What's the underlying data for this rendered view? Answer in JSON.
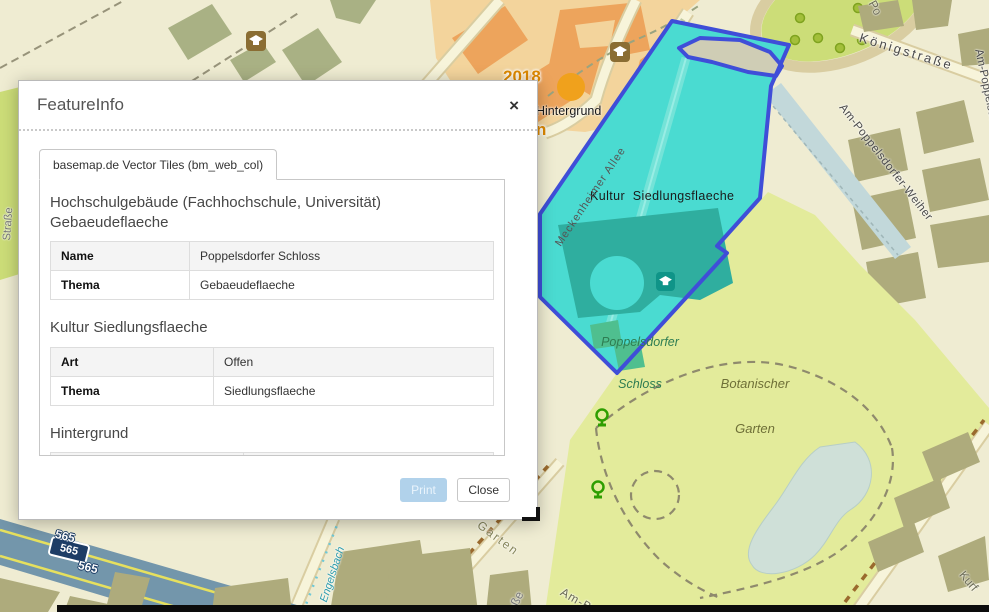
{
  "dialog": {
    "title": "FeatureInfo",
    "close_icon": "×",
    "tab_label": "basemap.de Vector Tiles (bm_web_col)",
    "sections": [
      {
        "heading": "Hochschulgebäude (Fachhochschule, Universität)",
        "heading2": "Gebaeudeflaeche",
        "rows": [
          {
            "label": "Name",
            "value": "Poppelsdorfer Schloss"
          },
          {
            "label": "Thema",
            "value": "Gebaeudeflaeche"
          }
        ]
      },
      {
        "heading": "Kultur Siedlungsflaeche",
        "heading2": "",
        "rows": [
          {
            "label": "Art",
            "value": "Offen"
          },
          {
            "label": "Thema",
            "value": "Siedlungsflaeche"
          }
        ]
      },
      {
        "heading": "Hintergrund",
        "heading2": "",
        "rows": [
          {
            "label": "Thema",
            "value": "Hintergrund"
          }
        ]
      }
    ],
    "buttons": {
      "print": "Print",
      "close": "Close"
    }
  },
  "map": {
    "city": {
      "year": "2018",
      "name": "Bonn"
    },
    "labels": {
      "hintergrund": "Hintergrund",
      "kultur_siedlungsflaeche": "Kultur  Siedlungsflaeche",
      "schloss_line1": "Poppelsdorfer",
      "schloss_line2": "Schloss",
      "botanischer_line1": "Botanischer",
      "botanischer_line2": "Garten",
      "koenigstrasse": "Königstraße",
      "am_poppelsdorfer_weiher": "Am-Poppelsdorfer-Weiher",
      "meckenheimer_allee": "Meckenheimer Allee",
      "engelsbach": "Engelsbach",
      "route_565": "565",
      "garten_fragment": "Garten",
      "am_bot_fragment": "Am-Bot",
      "strasse_fragment": "aße",
      "kurf_fragment": "Kurf",
      "po_fragment": "Po",
      "left_street_fragment": "Straße"
    },
    "colors": {
      "base": "#efecd2",
      "orange-zone": "#f3d49c",
      "orange-bld": "#eda45c",
      "sage": "#a9b184",
      "khaki": "#aeab7c",
      "park": "#e3eb9b",
      "oval": "#ccdd78",
      "tree": "#a3bf3a",
      "tree-ring": "#7fa31f",
      "pond": "#cfe0d8",
      "weiher": "#c2d8da",
      "road-fill": "#f7f4da",
      "road-casing": "#d9cda1",
      "hwy": "#7396ab",
      "hwy-line": "#e6e05e",
      "sel-fill": "#4adbd1",
      "sel-border": "#3f4ed8",
      "schloss": "#2fae9f",
      "greenhouse": "#4fbf8f",
      "badge": "#1d3d66",
      "marker": "#f0a11c"
    }
  }
}
